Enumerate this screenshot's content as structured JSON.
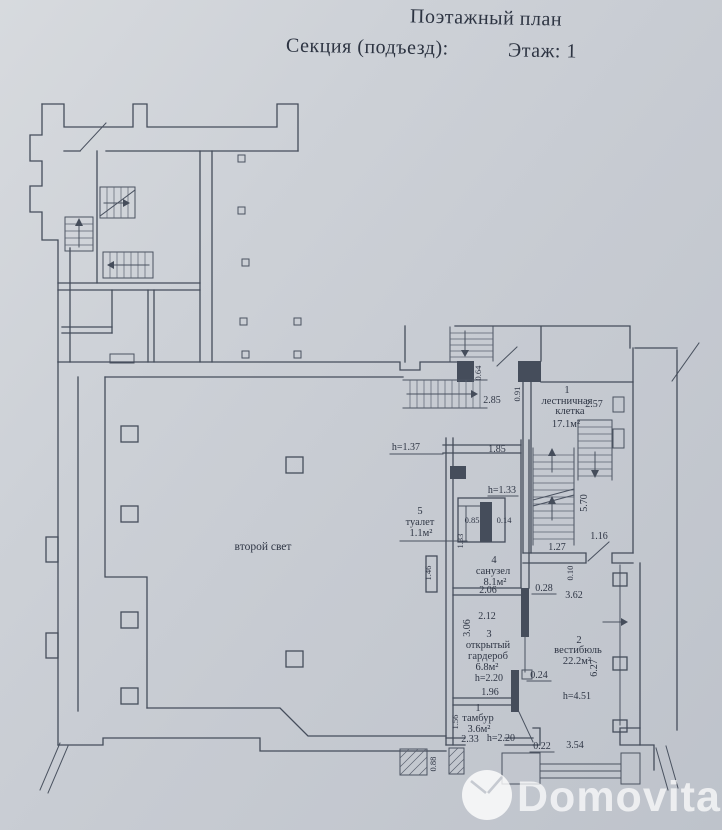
{
  "header": {
    "title": "Поэтажный план",
    "section": "Секция (подъезд):",
    "floor": "Этаж: 1"
  },
  "rooms": {
    "second_light": {
      "label": "второй свет"
    },
    "stairwell": {
      "num": "1",
      "line1": "лестничная",
      "line2": "клетка",
      "area": "17.1м²"
    },
    "toilet": {
      "num": "5",
      "name": "туалет",
      "area": "1.1м²"
    },
    "bathroom": {
      "num": "4",
      "name": "санузел",
      "area": "8.1м²"
    },
    "wardrobe": {
      "num": "3",
      "line1": "открытый",
      "line2": "гардероб",
      "area": "6.8м²"
    },
    "vestibule": {
      "num": "2",
      "name": "вестибюль",
      "area": "22.2м²"
    },
    "tambour": {
      "num": "1",
      "name": "тамбур",
      "area": "3.6м²"
    }
  },
  "dims": {
    "d064": "0.64",
    "d091": "0.91",
    "d285": "2.85",
    "d257": "2.57",
    "d185": "1.85",
    "h137": "h=1.37",
    "h133": "h=1.33",
    "d085": "0.85",
    "d014": "0.14",
    "d133": "1.33",
    "d570": "5.70",
    "d116": "1.16",
    "d127": "1.27",
    "d010": "0.10",
    "d146": "1.46",
    "d206": "2.06",
    "d028": "0.28",
    "d362": "3.62",
    "d212": "2.12",
    "d306": "3.06",
    "d627": "6.27",
    "d024": "0.24",
    "h220a": "h=2.20",
    "d196": "1.96",
    "d156": "1.56",
    "h451": "h=4.51",
    "d233": "2.33",
    "h220b": "h=2.20",
    "d022": "0.22",
    "d354": "3.54",
    "d088": "0.88"
  },
  "watermark": {
    "text": "Domovita"
  },
  "colors": {
    "paper": "#c9cdd4",
    "ink": "#454d5b",
    "text": "#2e3544",
    "watermark": "#ffffff"
  }
}
